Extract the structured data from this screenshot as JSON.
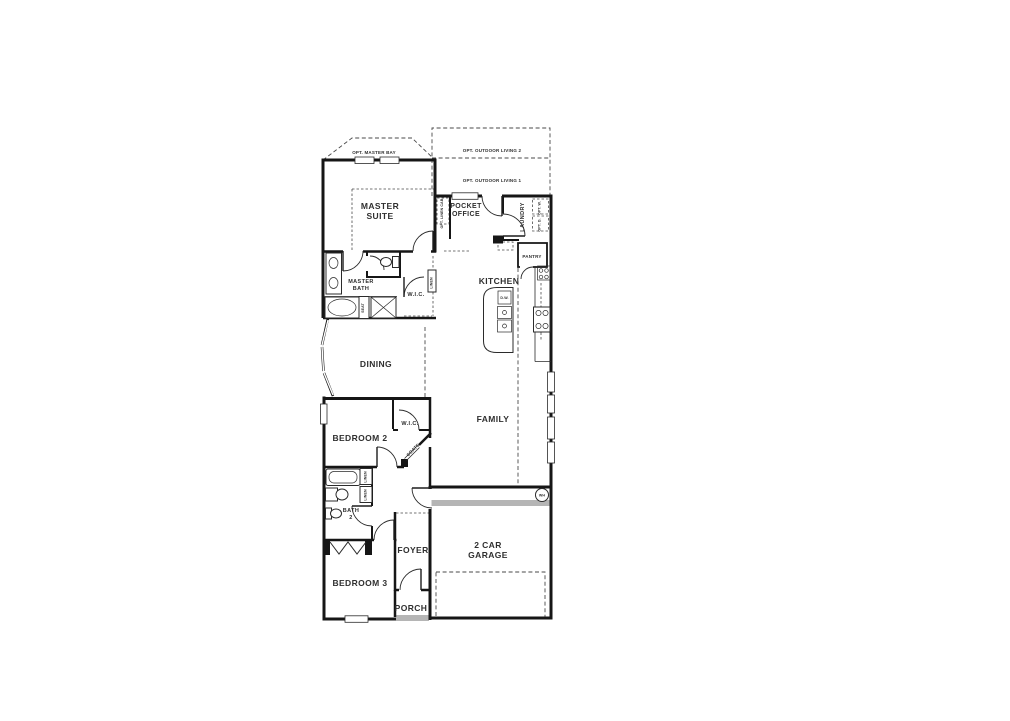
{
  "plan": {
    "colors": {
      "wall": "#161616",
      "step_gray": "#b5b5b5",
      "text": "#2f2f2f",
      "background": "#ffffff"
    },
    "labels": {
      "opt_outdoor_living_2": "OPT. OUTDOOR LIVING 2",
      "opt_outdoor_living_1": "OPT. OUTDOOR LIVING 1",
      "opt_master_bay": "OPT. MASTER BAY",
      "master_suite_1": "MASTER",
      "master_suite_2": "SUITE",
      "pocket_office_1": "POCKET",
      "pocket_office_2": "OFFICE",
      "opt_linen_cab": "OPT. LINEN CAB.",
      "laundry": "LAUNDRY",
      "opt_washer": "OPT. W.",
      "opt_dryer": "OPT. D.",
      "pantry": "PANTRY",
      "kitchen": "KITCHEN",
      "master_bath_1": "MASTER",
      "master_bath_2": "BATH",
      "wic_master": "W.I.C.",
      "linen_master": "LINEN",
      "seat": "SEAT",
      "dining": "DINING",
      "family": "FAMILY",
      "bedroom2": "BEDROOM 2",
      "wic_bedroom2": "W.I.C.",
      "coats": "COATS",
      "linen_hall_upper": "LINEN",
      "linen_hall_lower": "LINEN",
      "bath2_1": "BATH",
      "bath2_2": "2",
      "foyer": "FOYER",
      "bedroom3": "BEDROOM 3",
      "porch": "PORCH",
      "garage_1": "2 CAR",
      "garage_2": "GARAGE",
      "water_heater": "WH",
      "dishwasher": "D.W."
    }
  }
}
